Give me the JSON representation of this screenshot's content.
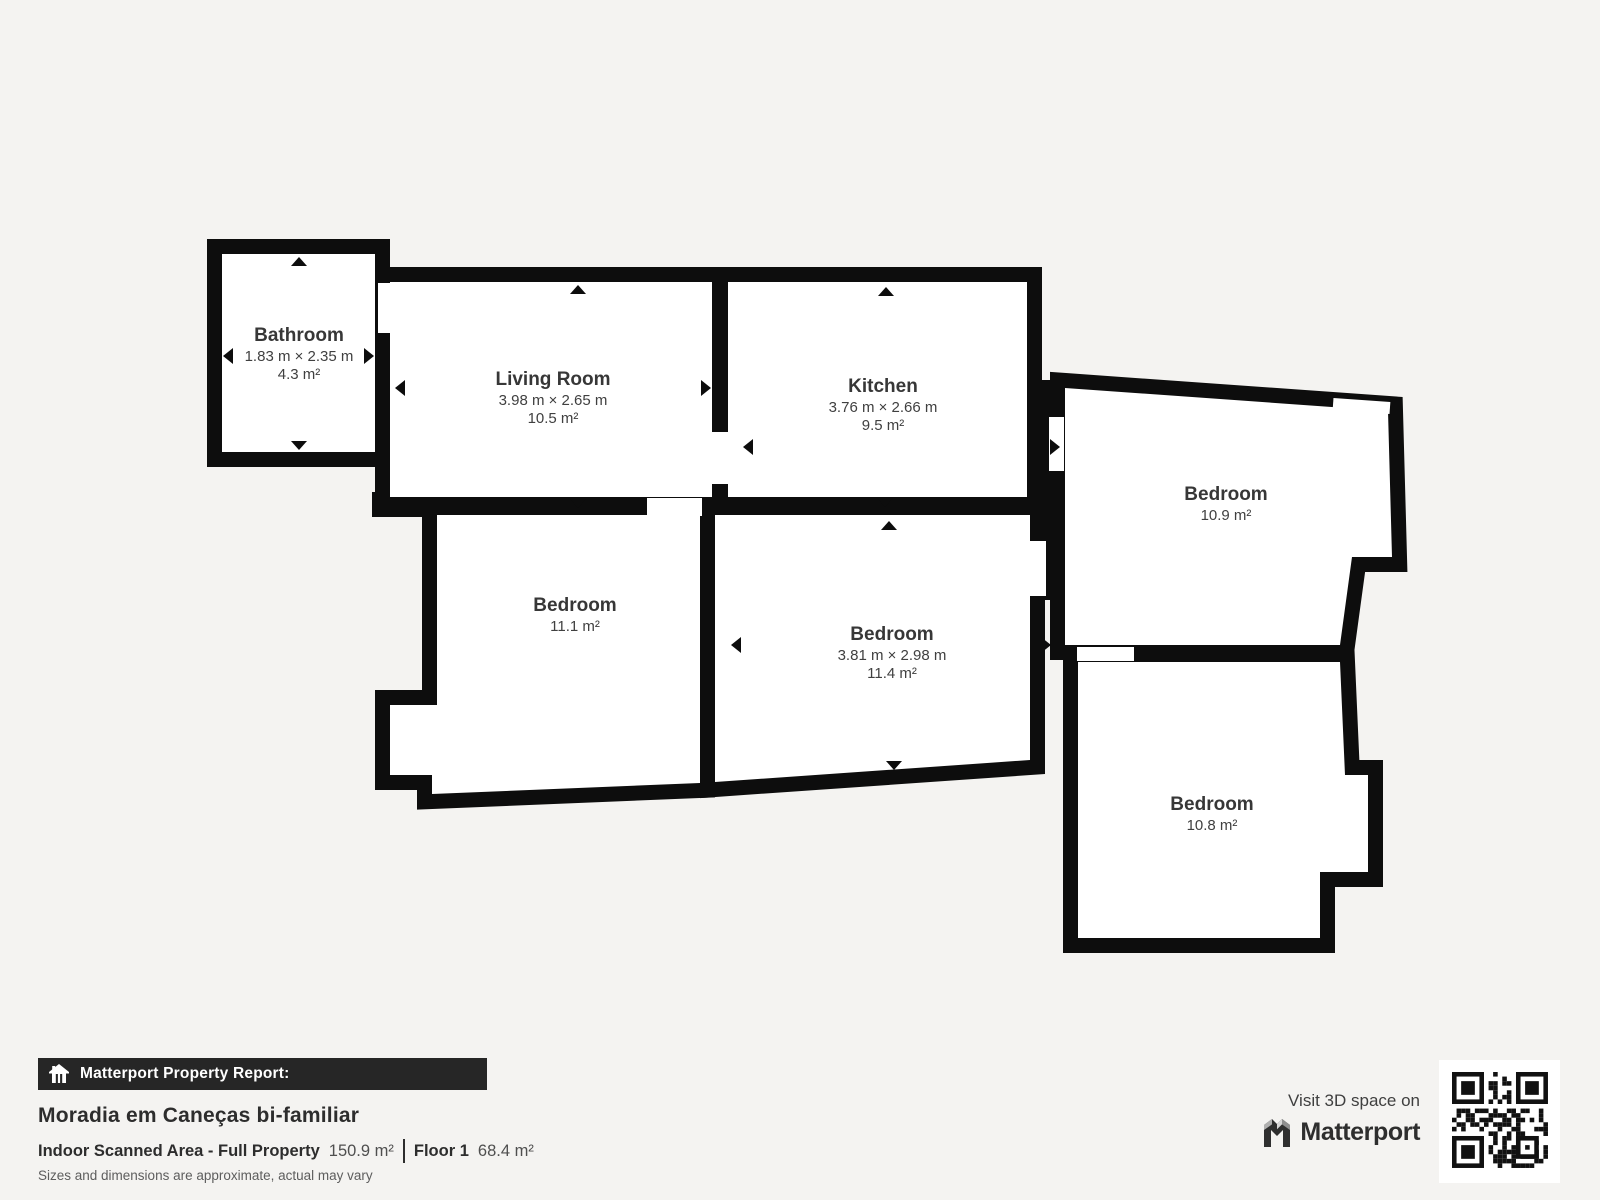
{
  "plan": {
    "rooms": [
      {
        "id": "bathroom",
        "name": "Bathroom",
        "dims": "1.83 m × 2.35 m",
        "area": "4.3 m²"
      },
      {
        "id": "living-room",
        "name": "Living Room",
        "dims": "3.98 m × 2.65 m",
        "area": "10.5 m²"
      },
      {
        "id": "kitchen",
        "name": "Kitchen",
        "dims": "3.76 m × 2.66 m",
        "area": "9.5 m²"
      },
      {
        "id": "bedroom-right",
        "name": "Bedroom",
        "dims": "",
        "area": "10.9 m²"
      },
      {
        "id": "bedroom-left",
        "name": "Bedroom",
        "dims": "",
        "area": "11.1 m²"
      },
      {
        "id": "bedroom-middle",
        "name": "Bedroom",
        "dims": "3.81 m × 2.98 m",
        "area": "11.4 m²"
      },
      {
        "id": "bedroom-bottom",
        "name": "Bedroom",
        "dims": "",
        "area": "10.8 m²"
      }
    ]
  },
  "report": {
    "banner_label": "Matterport Property Report:",
    "title": "Moradia em Caneças bi-familiar",
    "area_label": "Indoor Scanned Area - Full Property",
    "area_value": "150.9 m²",
    "floor_label": "Floor 1",
    "floor_value": "68.4 m²",
    "disclaimer": "Sizes and dimensions are approximate, actual may vary"
  },
  "promo": {
    "visit_label": "Visit 3D space on",
    "brand": "Matterport"
  },
  "colors": {
    "background": "#f4f3f1",
    "wall": "#0d0d0d",
    "room_fill": "#ffffff",
    "label_text": "#3c3c3c",
    "banner_bg": "#262626",
    "banner_text": "#ffffff"
  }
}
